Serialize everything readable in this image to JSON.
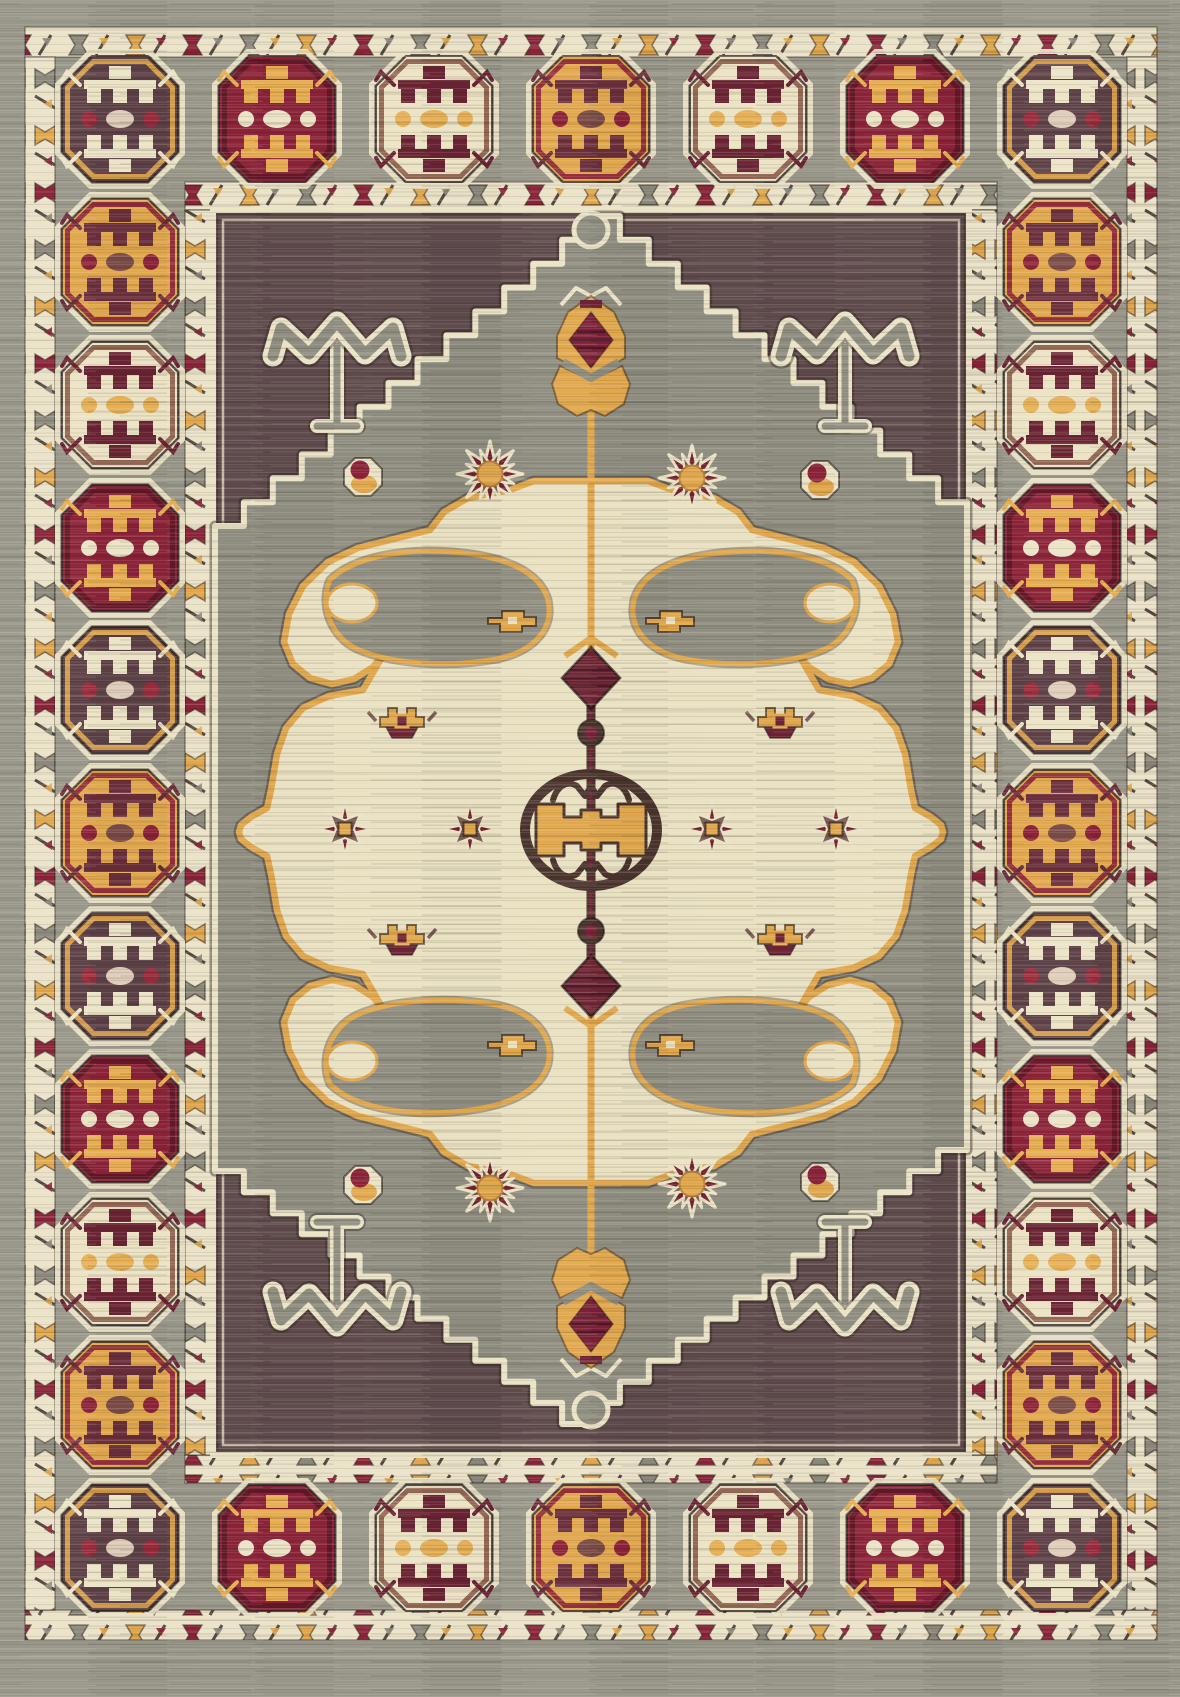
{
  "image": {
    "subject": "Oriental kilim-style area rug, portrait orientation, geometric tribal medallion design",
    "width": 1180,
    "height": 1697
  },
  "palette": {
    "gray_ground": "#99978a",
    "field_gray": "#8e8d80",
    "field_brown": "#5f4a4c",
    "cream": "#ebe3c6",
    "medallion_cream": "#e9e1c1",
    "gold": "#e2a74a",
    "gold_deep": "#b97f33",
    "red": "#8c2138",
    "maroon": "#6f2335",
    "maroon_spike": "#77202f",
    "mauve": "#7a5a55",
    "brown_gul": "#5c4046",
    "axis_brown": "#4a332d",
    "outline_dark": "#3e2d2b"
  },
  "layout": {
    "outer_gray": {
      "top": 27,
      "left": 25,
      "right": 23,
      "bottom": 57
    },
    "outer_guard": {
      "x": 25,
      "y": 27,
      "x2": 1157,
      "y2": 1640,
      "thickness": 30
    },
    "inner_guard": {
      "x": 185,
      "y": 182,
      "x2": 997,
      "y2": 1483,
      "thickness": 28
    },
    "field": {
      "x": 213,
      "y": 210,
      "w": 756,
      "h": 1245
    }
  },
  "guards": {
    "bg": "#ebe3c8",
    "outer_colors": [
      "#8c2138",
      "#8a897c",
      "#e2a74a"
    ],
    "inner_colors": [
      "#8c2138",
      "#e2a74a",
      "#8a897c"
    ]
  },
  "border_octagons": {
    "size": {
      "w": 116,
      "h": 126,
      "cut": 30
    },
    "schemes": {
      "brown": {
        "bg": "#5c4046",
        "ring": "#e2a74a",
        "motif": "#ece4c6",
        "dots": [
          "#9c2a3c",
          "#e0cdb9",
          "#9c2a3c"
        ]
      },
      "gold": {
        "bg": "#e3a74b",
        "ring": "#8c2138",
        "motif": "#6b2d3a",
        "dots": [
          "#8c2138",
          "#7a4a45",
          "#8c2138"
        ]
      },
      "cream": {
        "bg": "#ece3c4",
        "ring": "#8c5a4a",
        "motif": "#6b2333",
        "dots": [
          "#e8b054",
          "#e8b054",
          "#e8b054"
        ]
      },
      "red": {
        "bg": "#8c2138",
        "ring": "#5e1626",
        "motif": "#e8ad4e",
        "dots": [
          "#ece4c6",
          "#ece4c6",
          "#ece4c6"
        ]
      }
    },
    "rows": [
      {
        "name": "top",
        "y": 119,
        "xs": [
          120,
          277,
          434,
          591,
          748,
          905,
          1062
        ],
        "schemes": [
          "brown",
          "red",
          "cream",
          "gold",
          "cream",
          "red",
          "brown"
        ]
      },
      {
        "name": "bottom",
        "y": 1548,
        "xs": [
          120,
          277,
          434,
          591,
          748,
          905,
          1062
        ],
        "schemes": [
          "brown",
          "red",
          "cream",
          "gold",
          "cream",
          "red",
          "brown"
        ]
      }
    ],
    "cols": [
      {
        "name": "left",
        "x": 120,
        "ys": [
          262,
          405,
          548,
          690,
          833,
          976,
          1119,
          1262,
          1405
        ],
        "schemes": [
          "gold",
          "cream",
          "red",
          "brown",
          "gold",
          "brown",
          "red",
          "cream",
          "gold"
        ]
      },
      {
        "name": "right",
        "x": 1062,
        "ys": [
          262,
          405,
          548,
          690,
          833,
          976,
          1119,
          1262,
          1405
        ],
        "schemes": [
          "gold",
          "cream",
          "red",
          "brown",
          "gold",
          "brown",
          "red",
          "cream",
          "gold"
        ]
      }
    ]
  },
  "field": {
    "diamond_points": [
      [
        591,
        216
      ],
      [
        967,
        526
      ],
      [
        967,
        1150
      ],
      [
        591,
        1424
      ],
      [
        215,
        1150
      ],
      [
        215,
        526
      ]
    ],
    "apex_knobs": [
      {
        "x": 591,
        "y": 230
      },
      {
        "x": 591,
        "y": 1410
      }
    ],
    "arrows": [
      {
        "x": 337,
        "y": 352,
        "dir": 1
      },
      {
        "x": 845,
        "y": 352,
        "dir": 1
      },
      {
        "x": 337,
        "y": 1296,
        "dir": -1
      },
      {
        "x": 845,
        "y": 1296,
        "dir": -1
      }
    ],
    "tulips": [
      {
        "x": 591,
        "y": 341,
        "dir": 1
      },
      {
        "x": 591,
        "y": 1323,
        "dir": -1
      }
    ],
    "sunflowers": [
      {
        "x": 490,
        "y": 474
      },
      {
        "x": 692,
        "y": 478
      },
      {
        "x": 490,
        "y": 1188
      },
      {
        "x": 692,
        "y": 1184
      }
    ],
    "rosettes": [
      {
        "x": 363,
        "y": 477
      },
      {
        "x": 820,
        "y": 480
      },
      {
        "x": 363,
        "y": 1185
      },
      {
        "x": 820,
        "y": 1182
      }
    ]
  },
  "medallion": {
    "cx": 591,
    "cy": 832,
    "quarter": [
      [
        591,
        481
      ],
      [
        534,
        481
      ],
      [
        510,
        490
      ],
      [
        468,
        498
      ],
      [
        444,
        512
      ],
      [
        430,
        530
      ],
      [
        398,
        538
      ],
      [
        358,
        548
      ],
      [
        328,
        562
      ],
      [
        303,
        586
      ],
      [
        289,
        614
      ],
      [
        284,
        642
      ],
      [
        293,
        664
      ],
      [
        310,
        678
      ],
      [
        332,
        684
      ],
      [
        354,
        679
      ],
      [
        373,
        667
      ],
      [
        385,
        652
      ],
      [
        363,
        690
      ],
      [
        329,
        696
      ],
      [
        303,
        708
      ],
      [
        286,
        728
      ],
      [
        277,
        754
      ],
      [
        271,
        790
      ],
      [
        267,
        808
      ],
      [
        251,
        817
      ],
      [
        241,
        825
      ],
      [
        239,
        832
      ]
    ],
    "crown_stars": [
      {
        "x": 402,
        "y": 719
      },
      {
        "x": 780,
        "y": 719
      },
      {
        "x": 402,
        "y": 936
      },
      {
        "x": 780,
        "y": 936
      }
    ],
    "spiky_stars": [
      {
        "x": 345,
        "y": 829
      },
      {
        "x": 470,
        "y": 829
      },
      {
        "x": 712,
        "y": 829
      },
      {
        "x": 836,
        "y": 829
      }
    ],
    "wing_keys": [
      {
        "x": 512,
        "y": 620
      },
      {
        "x": 670,
        "y": 620
      },
      {
        "x": 512,
        "y": 1044
      },
      {
        "x": 670,
        "y": 1044
      }
    ]
  },
  "axis": {
    "rod": {
      "x": 591,
      "y1": 652,
      "y2": 1012
    },
    "ring": {
      "cx": 591,
      "cy": 830,
      "rx": 66,
      "ry": 56
    },
    "diamonds": [
      {
        "x": 591,
        "y": 678,
        "dir": 1
      },
      {
        "x": 591,
        "y": 986,
        "dir": -1
      }
    ],
    "balls": [
      {
        "x": 591,
        "y": 733
      },
      {
        "x": 591,
        "y": 931
      }
    ]
  }
}
